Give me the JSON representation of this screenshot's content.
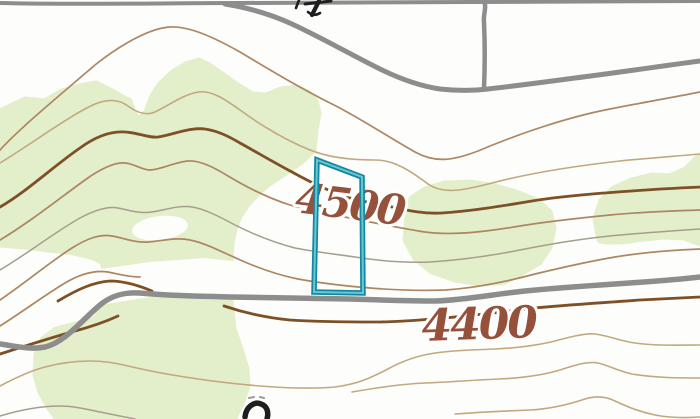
{
  "map": {
    "view_title": "topographic-map-view",
    "contour_labels": {
      "c4500": "4500",
      "c4400": "4400"
    },
    "colors": {
      "background": "#fdfdfb",
      "vegetation": "#e3efca",
      "contour_regular": "#ad8662",
      "contour_light": "#c2a87e",
      "contour_gray": "#a59e8d",
      "contour_index": "#7d5026",
      "label_text": "#96513a",
      "road": "#8d8d8d",
      "parcel_outer": "#1488a0",
      "parcel_inner": "#69c7d5",
      "symbol_black": "#1e1e1e",
      "symbol_gray": "#9a9a9a"
    }
  }
}
